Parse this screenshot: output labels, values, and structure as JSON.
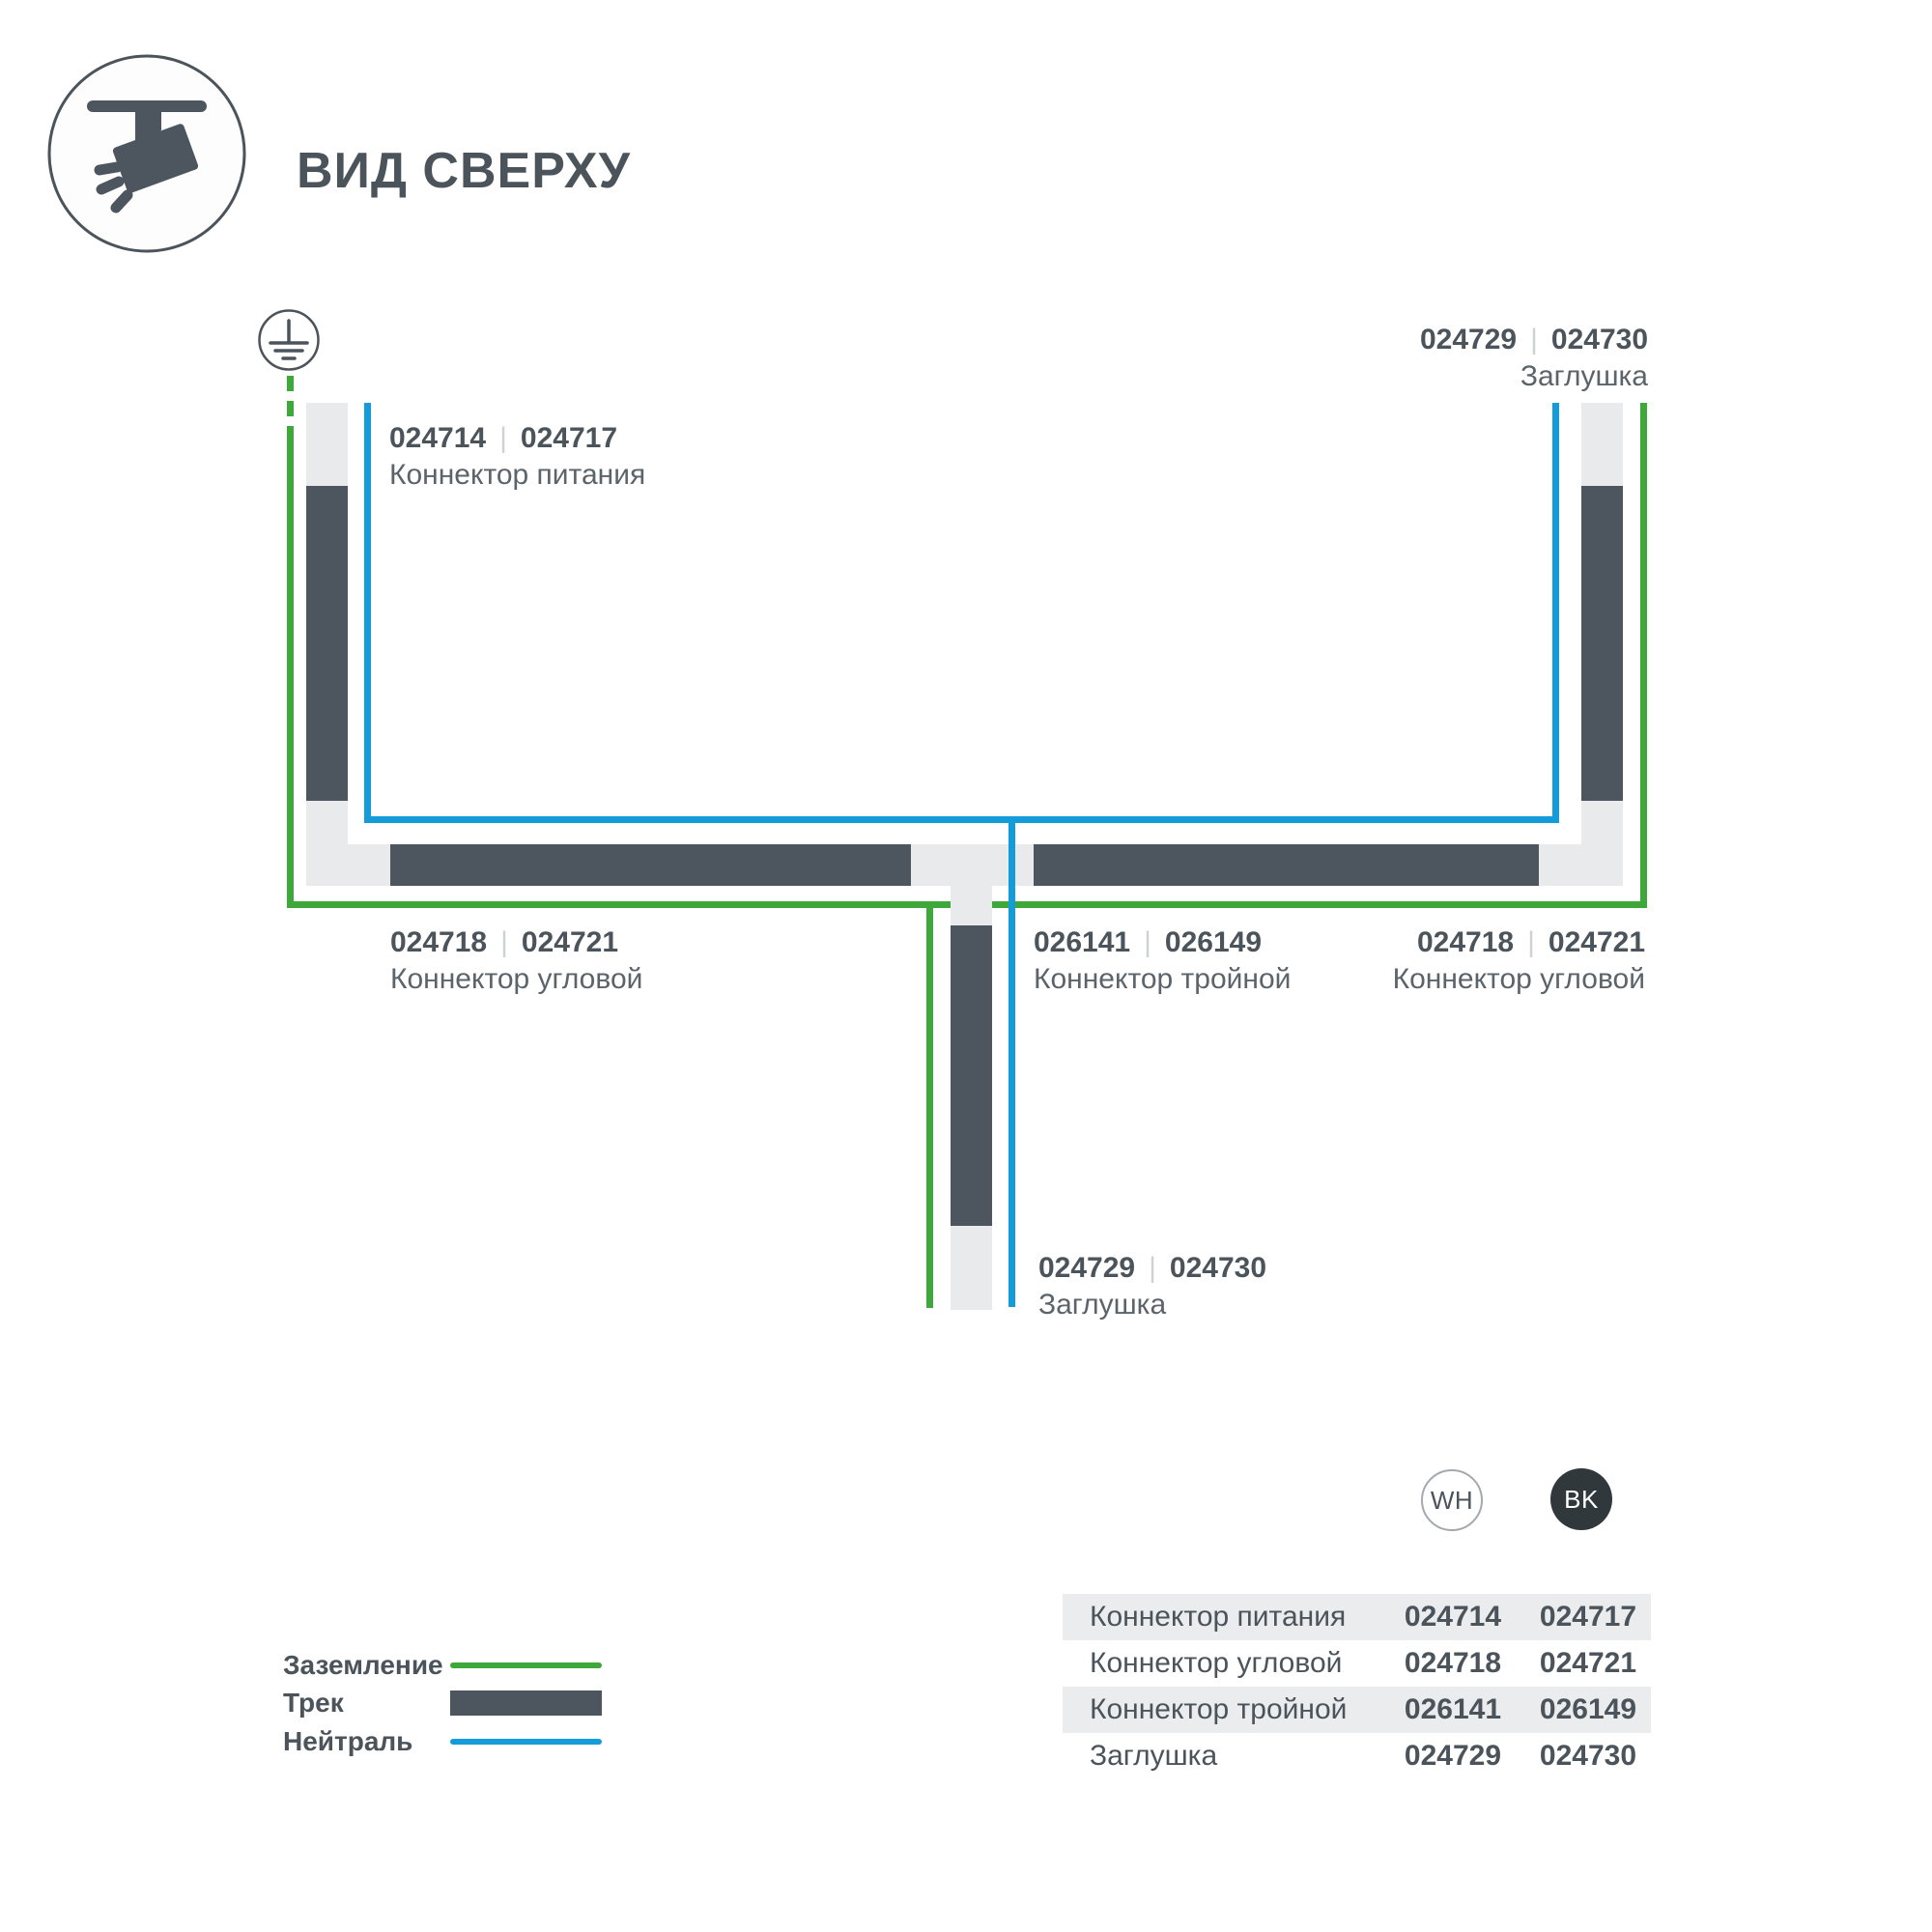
{
  "ui": {
    "pipe": "|"
  },
  "header": {
    "title": "ВИД СВЕРХУ"
  },
  "colors": {
    "track_dark": "#4d565e",
    "track_light": "#e8eaec",
    "ground_green": "#3ea83b",
    "neutral_blue": "#149cda",
    "table_shade": "#eaecee",
    "text": "#4b535b"
  },
  "diagram": {
    "labels": {
      "power": {
        "num_wh": "024714",
        "num_bk": "024717",
        "name": "Коннектор питания"
      },
      "endcap_top": {
        "num_wh": "024729",
        "num_bk": "024730",
        "name": "Заглушка"
      },
      "corner_left": {
        "num_wh": "024718",
        "num_bk": "024721",
        "name": "Коннектор угловой"
      },
      "tee": {
        "num_wh": "026141",
        "num_bk": "026149",
        "name": "Коннектор тройной"
      },
      "corner_right": {
        "num_wh": "024718",
        "num_bk": "024721",
        "name": "Коннектор угловой"
      },
      "endcap_bottom": {
        "num_wh": "024729",
        "num_bk": "024730",
        "name": "Заглушка"
      }
    }
  },
  "legend": {
    "ground": "Заземление",
    "track": "Трек",
    "neutral": "Нейтраль"
  },
  "variants": {
    "white": "WH",
    "black": "BK"
  },
  "table": {
    "rows": [
      {
        "name": "Коннектор питания",
        "wh": "024714",
        "bk": "024717"
      },
      {
        "name": "Коннектор угловой",
        "wh": "024718",
        "bk": "024721"
      },
      {
        "name": "Коннектор тройной",
        "wh": "026141",
        "bk": "026149"
      },
      {
        "name": "Заглушка",
        "wh": "024729",
        "bk": "024730"
      }
    ]
  }
}
